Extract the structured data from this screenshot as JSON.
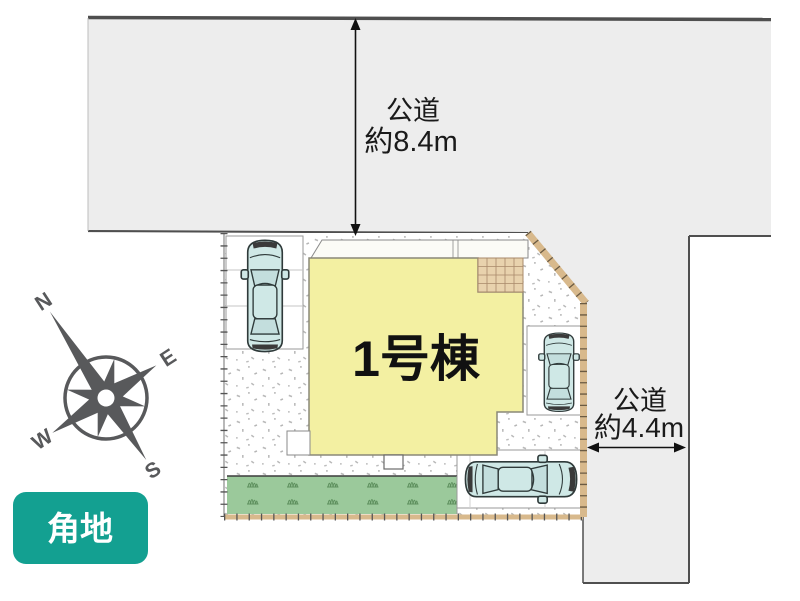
{
  "labels": {
    "building": "1号棟",
    "road_top_line1": "公道",
    "road_top_line2": "約8.4m",
    "road_right_line1": "公道",
    "road_right_line2": "約4.4m",
    "badge": "角地"
  },
  "compass": {
    "north": "N",
    "east": "E",
    "south": "S",
    "west": "W"
  },
  "colors": {
    "road": "#ededed",
    "road_border": "#4f4f4f",
    "lot_base": "#ffffff",
    "building": "#f3f0a2",
    "building_border": "#8a8878",
    "entrance_tile": "#e8d2ad",
    "entrance_tile_line": "#a8896a",
    "grass": "#9bc99b",
    "grass_tuft": "#5d8f5d",
    "car_body": "#cfe8e6",
    "car_window": "#c3dedd",
    "car_outline": "#2f3a3a",
    "boundary_tan": "#d8b98c",
    "badge_bg": "#13a091",
    "badge_text": "#ffffff",
    "compass": "#58595b",
    "dimension_text": "#1a1a1a"
  }
}
